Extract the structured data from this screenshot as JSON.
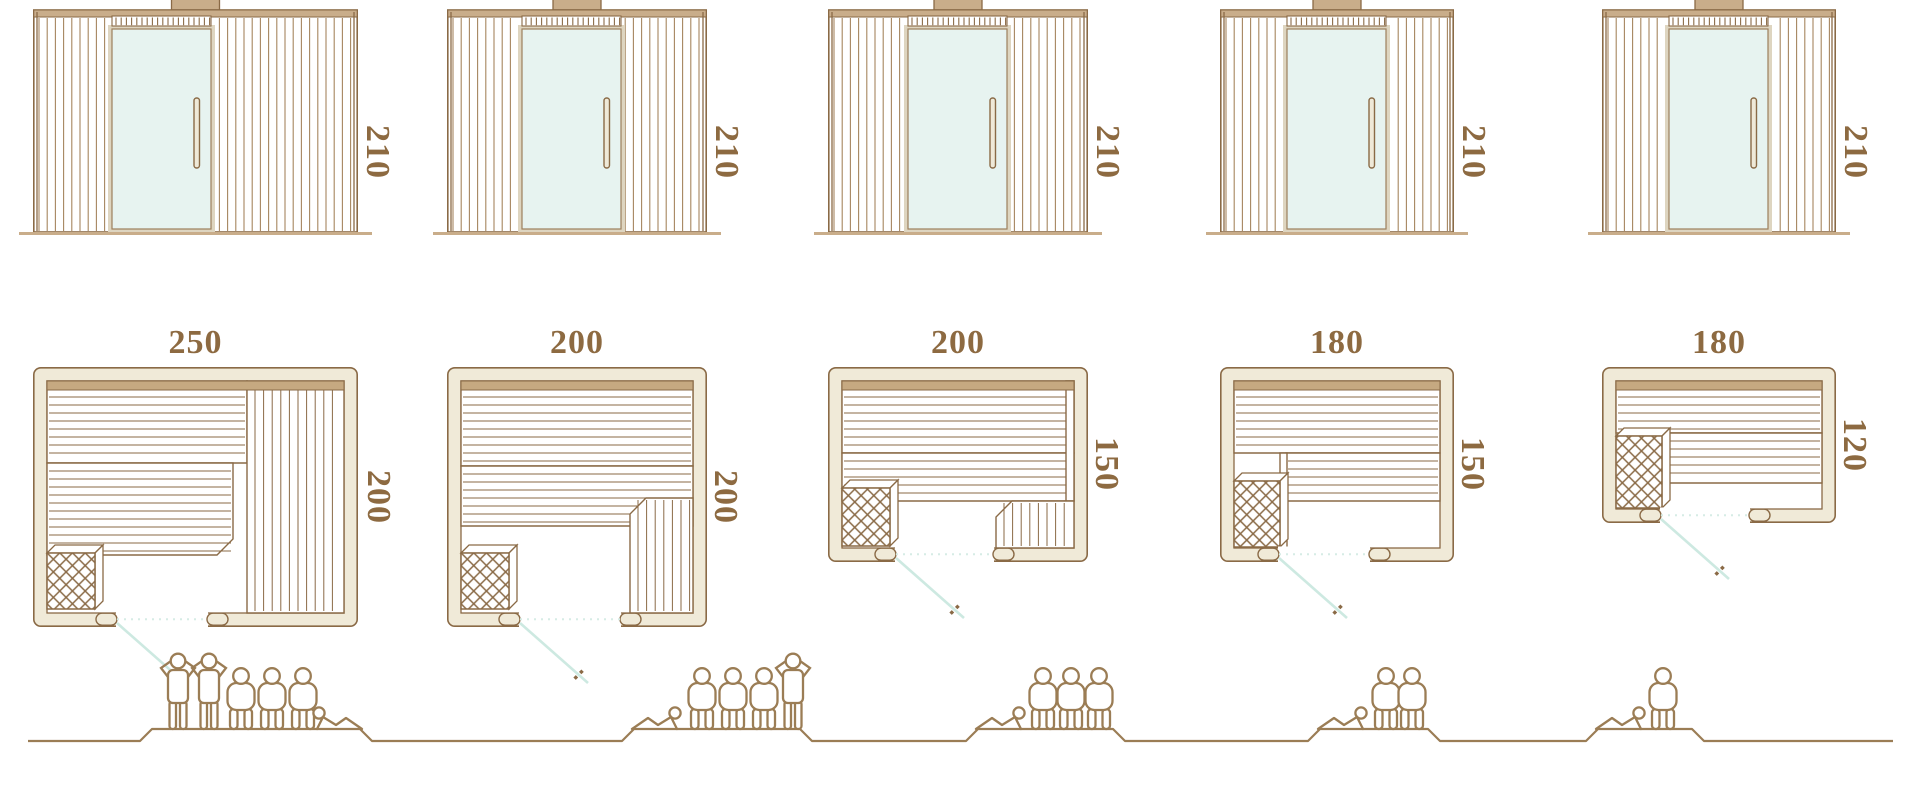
{
  "colors": {
    "outline_brown": "#8a6a46",
    "slat_brown": "#a5855f",
    "wood_tan": "#c9ad8a",
    "band_tan": "#c6a981",
    "wall_cream": "#f0ead8",
    "door_frame_cream": "#ded5c0",
    "glass_mint": "#e7f3f0",
    "door_swing_teal": "#cde9e1",
    "dotted_teal": "#d6ece5",
    "label_brown": "#8d6a41",
    "figure_brown": "#9b7d55"
  },
  "models": [
    {
      "name": "sauna-250x200",
      "front_elevation": {
        "height_label": "210"
      },
      "floor_plan": {
        "width_label": "250",
        "depth_label": "200"
      },
      "capacity": 6,
      "people": [
        "person-standing",
        "person-standing",
        "person-seated",
        "person-seated",
        "person-seated",
        "person-lying"
      ]
    },
    {
      "name": "sauna-200x200",
      "front_elevation": {
        "height_label": "210"
      },
      "floor_plan": {
        "width_label": "200",
        "depth_label": "200"
      },
      "capacity": 5,
      "people": [
        "person-lying",
        "person-seated",
        "person-seated",
        "person-seated",
        "person-standing"
      ]
    },
    {
      "name": "sauna-200x150",
      "front_elevation": {
        "height_label": "210"
      },
      "floor_plan": {
        "width_label": "200",
        "depth_label": "150"
      },
      "capacity": 4,
      "people": [
        "person-lying",
        "person-seated",
        "person-seated",
        "person-seated"
      ]
    },
    {
      "name": "sauna-180x150",
      "front_elevation": {
        "height_label": "210"
      },
      "floor_plan": {
        "width_label": "180",
        "depth_label": "150"
      },
      "capacity": 3,
      "people": [
        "person-lying",
        "person-seated",
        "person-seated"
      ]
    },
    {
      "name": "sauna-180x120",
      "front_elevation": {
        "height_label": "210"
      },
      "floor_plan": {
        "width_label": "180",
        "depth_label": "120"
      },
      "capacity": 2,
      "people": [
        "person-lying",
        "person-seated"
      ]
    }
  ]
}
